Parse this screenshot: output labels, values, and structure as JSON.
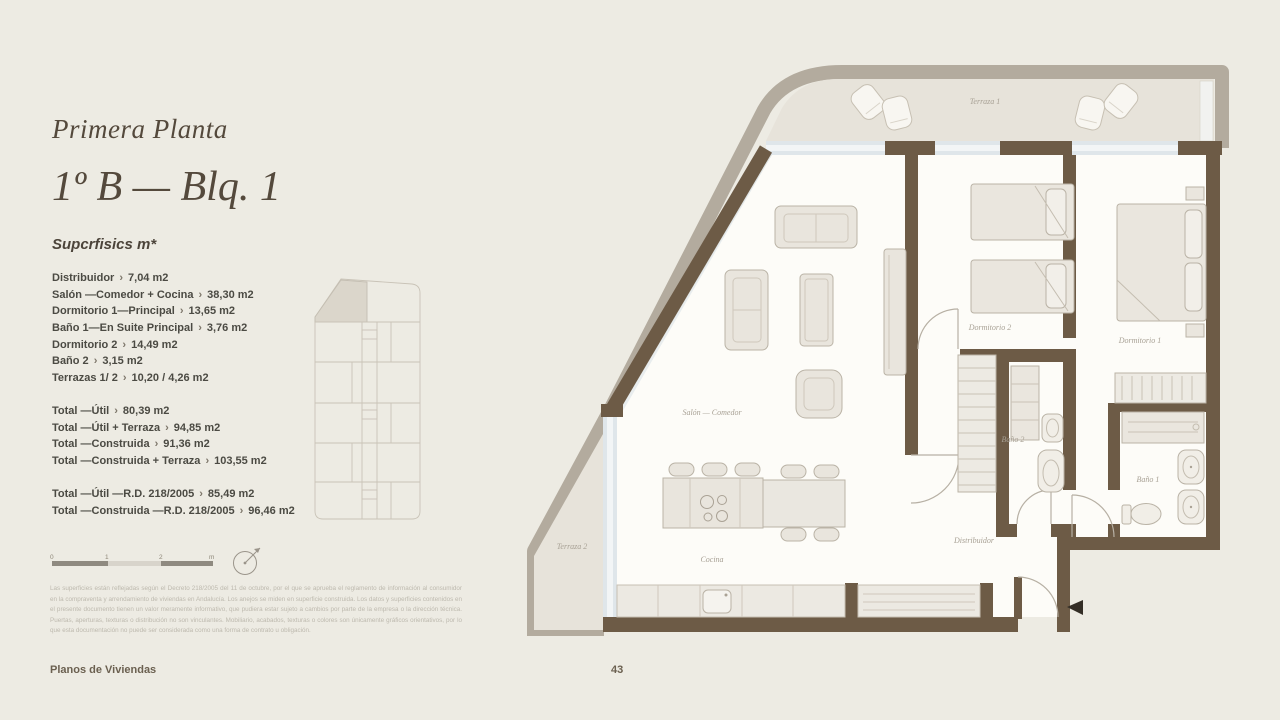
{
  "header": {
    "title": "Primera Planta",
    "unit": "1º B — Blq. 1",
    "subtitle": "Supcrfisics m*"
  },
  "areas": {
    "separator": "›",
    "items": [
      {
        "label": "Distribuidor",
        "value": "7,04 m2"
      },
      {
        "label": "Salón —Comedor + Cocina",
        "value": "38,30 m2"
      },
      {
        "label": "Dormitorio 1—Principal",
        "value": "13,65 m2"
      },
      {
        "label": "Baño 1—En Suite Principal",
        "value": "3,76 m2"
      },
      {
        "label": "Dormitorio 2",
        "value": "14,49 m2"
      },
      {
        "label": "Baño 2",
        "value": "3,15 m2"
      },
      {
        "label": "Terrazas 1/ 2",
        "value": "10,20 / 4,26 m2"
      }
    ],
    "totals": [
      {
        "label": "Total —Útil",
        "value": "80,39 m2"
      },
      {
        "label": "Total —Útil + Terraza",
        "value": "94,85 m2"
      },
      {
        "label": "Total —Construida",
        "value": "91,36 m2"
      },
      {
        "label": "Total —Construida + Terraza",
        "value": "103,55 m2"
      }
    ],
    "totals_rd": [
      {
        "label": "Total —Útil —R.D. 218/2005",
        "value": "85,49 m2"
      },
      {
        "label": "Total —Construida —R.D. 218/2005",
        "value": "96,46 m2"
      }
    ]
  },
  "scalebar": {
    "labels": [
      "0",
      "1",
      "2",
      "m"
    ]
  },
  "disclaimer": "Las superficies están reflejadas según el Decreto 218/2005 del 11 de octubre, por el que se aprueba el reglamento de información al consumidor en la compraventa y arrendamiento de viviendas en Andalucía. Los anejos se miden en superficie construida. Los datos y superficies contenidos en el presente documento tienen un valor meramente informativo, que pudiera estar sujeto a cambios por parte de la empresa o la dirección técnica. Puertas, aperturas, texturas o distribución no son vinculantes. Mobiliario, acabados, texturas o colores son únicamente gráficos orientativos, por lo que esta documentación no puede ser considerada como una forma de contrato u obligación.",
  "footer": {
    "left": "Planos de Viviendas",
    "page_number": "43"
  },
  "plan": {
    "room_labels": [
      {
        "text": "Terraza 1"
      },
      {
        "text": "Dormitorio 2"
      },
      {
        "text": "Dormitorio 1"
      },
      {
        "text": "Salón — Comedor"
      },
      {
        "text": "Baño 2"
      },
      {
        "text": "Baño 1"
      },
      {
        "text": "Terraza 2"
      },
      {
        "text": "Cocina"
      },
      {
        "text": "Distribuidor"
      }
    ]
  },
  "colors": {
    "page_bg": "#edebe3",
    "wall": "#6d5b46",
    "outer_band": "#b3ab9e",
    "floor": "#fdfcf8",
    "terrace_floor": "#e7e3da",
    "glass": "#dfe6ea",
    "furniture": "#e9e5dd",
    "title_text": "#54493c",
    "list_text": "#4b4a43",
    "label_text": "#a8a195"
  }
}
